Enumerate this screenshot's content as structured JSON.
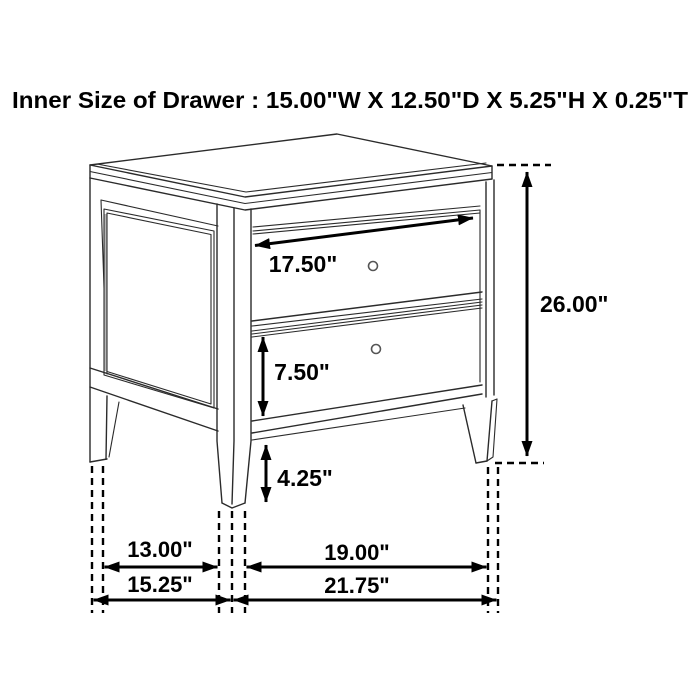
{
  "title": "Inner Size of Drawer : 15.00\"W X 12.50\"D X 5.25\"H X 0.25\"T",
  "inner_drawer_size": {
    "width": "15.00\"W",
    "depth": "12.50\"D",
    "height": "5.25\"H",
    "thickness": "0.25\"T"
  },
  "dimensions": {
    "drawer_front_width": "17.50\"",
    "overall_height": "26.00\"",
    "drawer_front_height": "7.50\"",
    "leg_height": "4.25\"",
    "side_leg_clearance": "13.00\"",
    "overall_depth": "15.25\"",
    "front_leg_clearance": "19.00\"",
    "overall_width": "21.75\""
  },
  "subject": "two-drawer nightstand dimension line drawing",
  "colors": {
    "background": "#ffffff",
    "figure_line": "#2b2b2b",
    "dimension_line": "#000000",
    "panel_shade": "#b8b8b8",
    "knob_line": "#555555"
  }
}
